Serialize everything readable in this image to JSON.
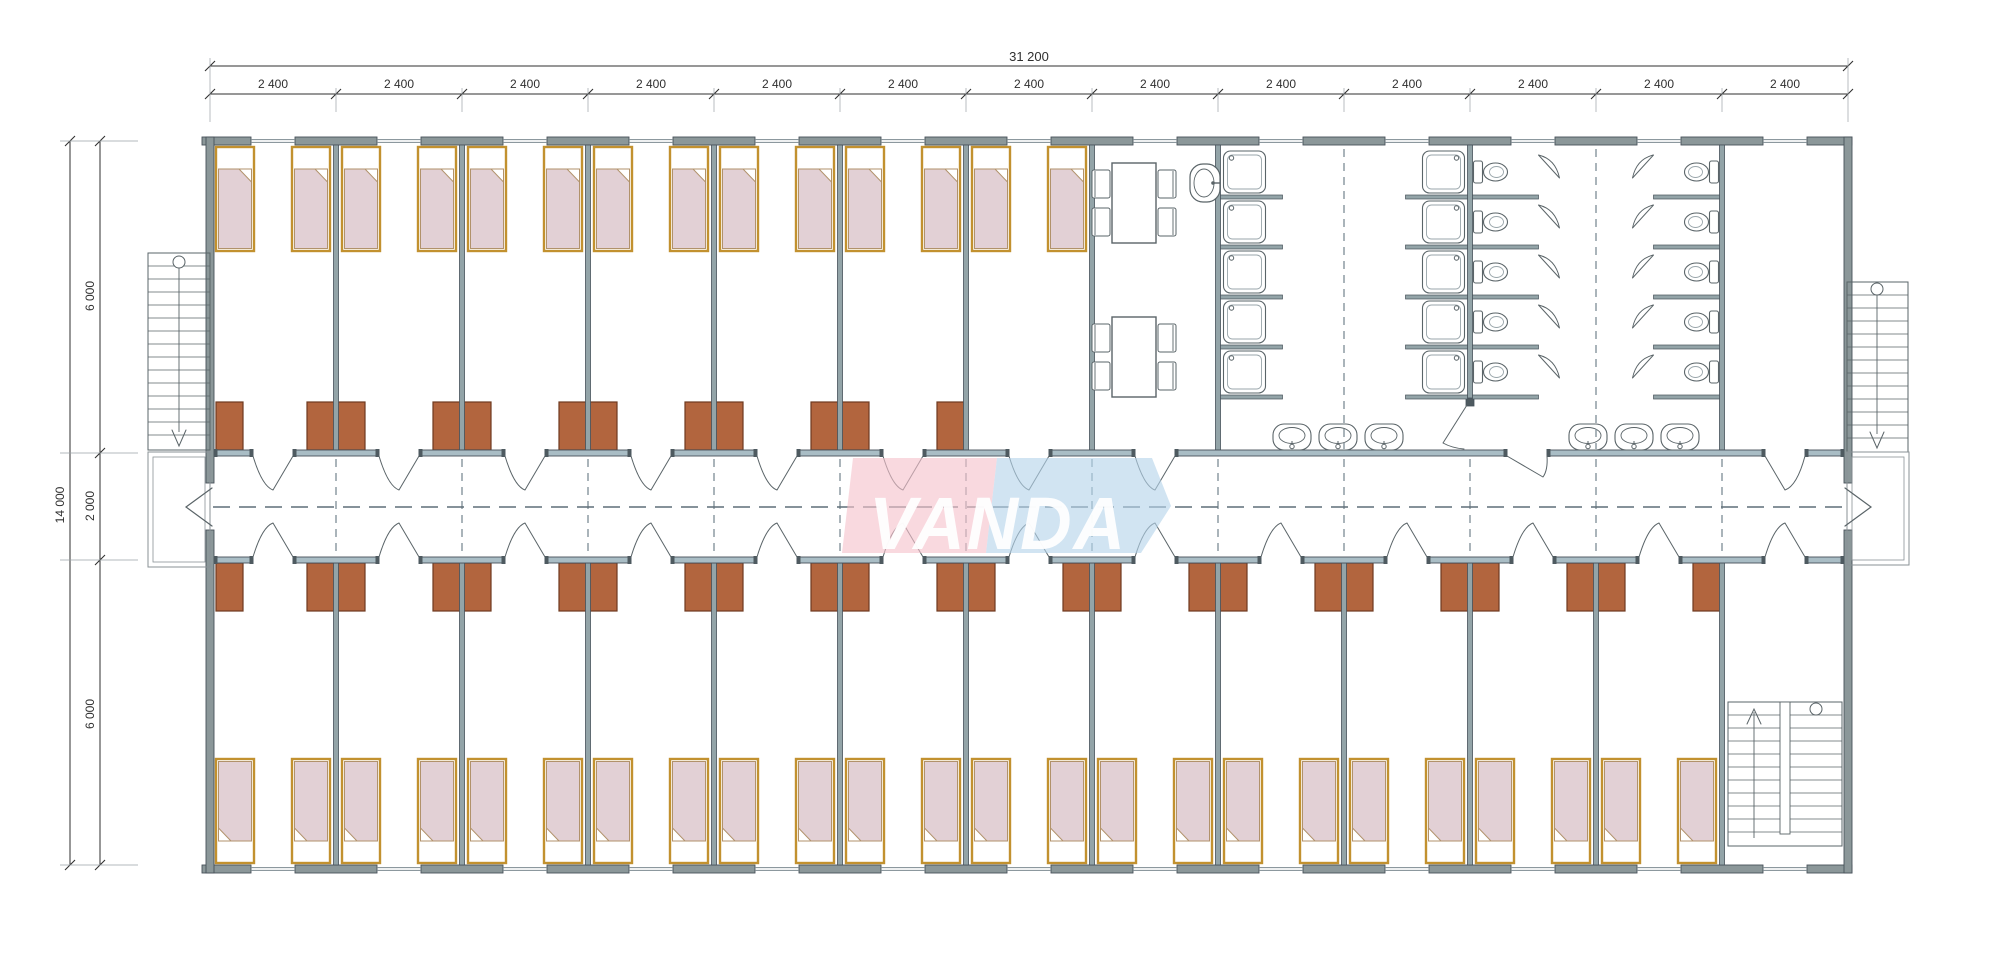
{
  "meta": {
    "drawing_type": "modular dormitory floor plan",
    "units": "mm"
  },
  "logo": {
    "text": "VANDA",
    "pink": "#f5c2cb",
    "blue": "#b5d4ea",
    "text_color": "#ffffff"
  },
  "dimensions": {
    "overall_width": "31 200",
    "bay_width": "2 400",
    "bay_count": 13,
    "overall_depth": "14 000",
    "depth_top_rooms": "6 000",
    "depth_corridor": "2 000",
    "depth_bottom_rooms": "6 000"
  },
  "counts": {
    "top_bedroom_bays": 7,
    "bottom_bedroom_bays": 12,
    "beds_top": 14,
    "beds_bottom": 24,
    "wardrobes_top": 12,
    "wardrobes_bottom": 24,
    "dining_tables": 2,
    "chairs_per_table": 4,
    "dining_sinks": 1,
    "shower_stalls": 10,
    "toilet_stalls": 10,
    "washbasins": 6,
    "external_stairs": 2,
    "internal_stairs": 1
  },
  "colors": {
    "wall_exterior": "#8b9799",
    "wall_partition": "#93a4a8",
    "wall_corridor": "#a9bdc5",
    "wall_outline": "#47525a",
    "wall_cap": "#4e5a60",
    "bed_frame": "#c2912f",
    "bed_blanket": "#e2d0d5",
    "wardrobe": "#b2653e",
    "wardrobe_outline": "#6e3a20",
    "fixture_line": "#5a6468",
    "dashed_joint": "#7d8c94",
    "centerline": "#5f6e78",
    "dimension": "#2f2f2f"
  }
}
